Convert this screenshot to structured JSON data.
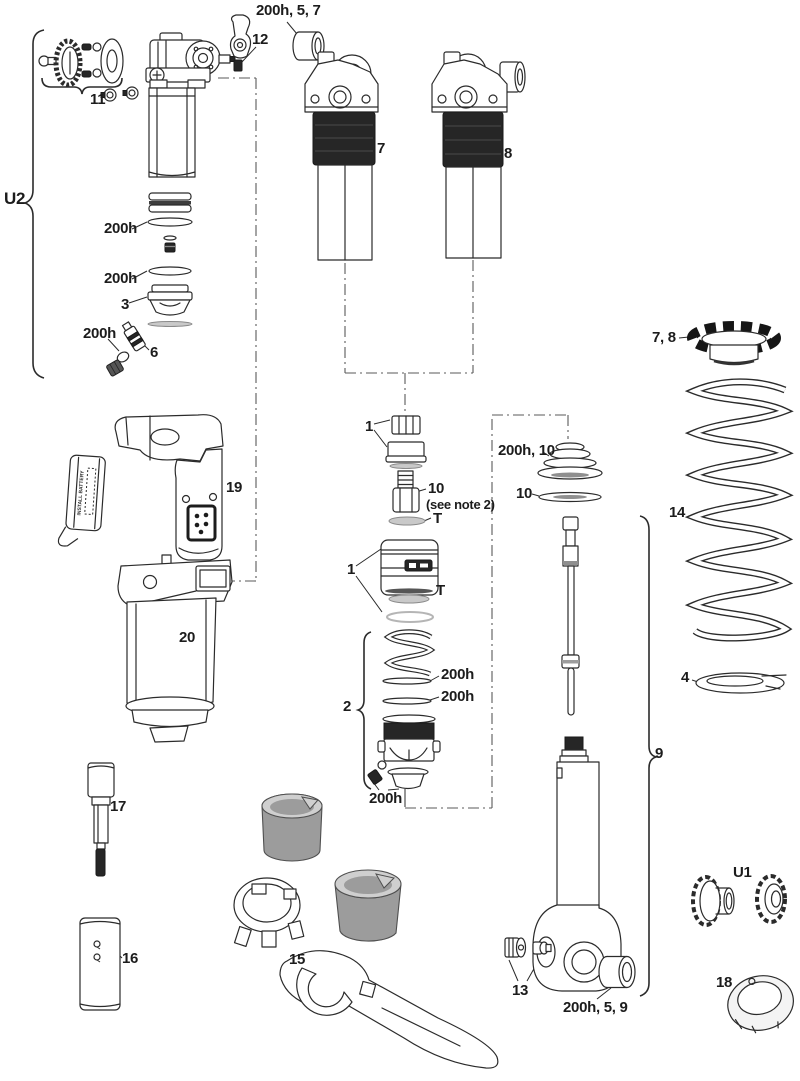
{
  "diagram": {
    "type": "exploded-parts-diagram",
    "subject": "rear shock service parts",
    "colors": {
      "line": "#2b2b2b",
      "dark_fill": "#262626",
      "tool_gray": "#9c9c9c",
      "background": "#ffffff"
    }
  },
  "labels": {
    "u2": "U2",
    "p11": "11",
    "p12": "12",
    "bushing_top": "200h, 5, 7",
    "p7": "7",
    "p8": "8",
    "stack_200h_a": "200h",
    "stack_200h_b": "200h",
    "p3": "3",
    "valve_200h": "200h",
    "p6": "6",
    "p1_a": "1",
    "p10_center": "10",
    "note": "(see note 2)",
    "t_a": "T",
    "p1_b": "1",
    "t_b": "T",
    "p19": "19",
    "p20": "20",
    "p2": "2",
    "ring_200h_a": "200h",
    "ring_200h_b": "200h",
    "base_200h": "200h",
    "sealhead": "200h, 10",
    "p10_right": "10",
    "p78": "7, 8",
    "p14": "14",
    "p4": "4",
    "p9": "9",
    "p13": "13",
    "bushing_bottom": "200h, 5, 9",
    "u1": "U1",
    "p18": "18",
    "p17": "17",
    "p16": "16",
    "p15": "15",
    "battery_text": "INSTALL BATTERY"
  }
}
